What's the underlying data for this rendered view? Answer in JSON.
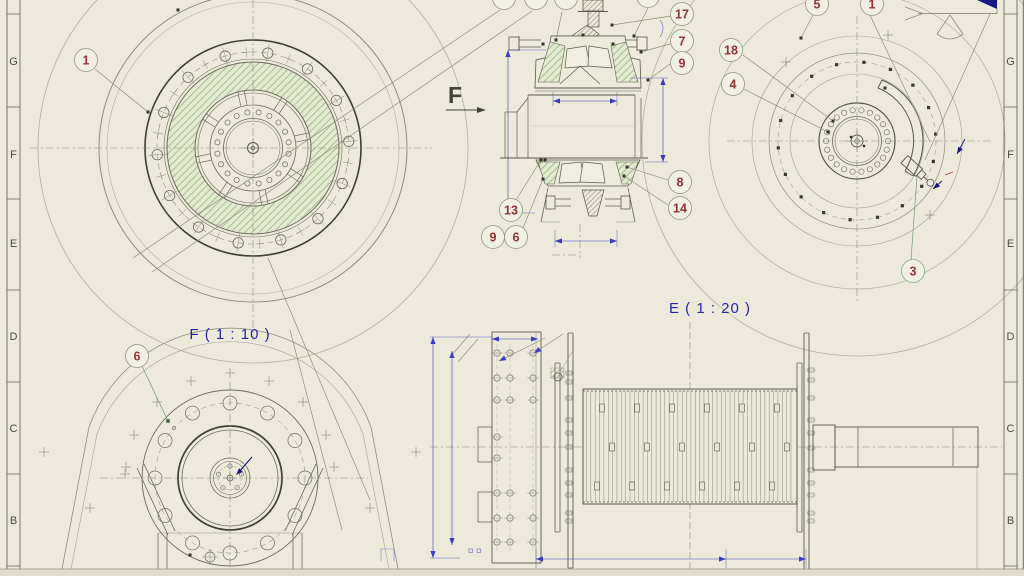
{
  "zones": [
    "G",
    "F",
    "E",
    "D",
    "C",
    "B"
  ],
  "labels": {
    "view_f": "F ( 1 : 10 )",
    "view_e": "E ( 1 : 20 )",
    "direction": "F"
  },
  "balloons": [
    {
      "id": "front-1",
      "label": "1"
    },
    {
      "id": "section-17",
      "label": "17"
    },
    {
      "id": "section-7",
      "label": "7"
    },
    {
      "id": "section-9-upper",
      "label": "9"
    },
    {
      "id": "section-8",
      "label": "8"
    },
    {
      "id": "section-14",
      "label": "14"
    },
    {
      "id": "section-13",
      "label": "13"
    },
    {
      "id": "section-9-lower",
      "label": "9"
    },
    {
      "id": "section-6",
      "label": "6"
    },
    {
      "id": "rear-5",
      "label": "5"
    },
    {
      "id": "rear-1",
      "label": "1"
    },
    {
      "id": "rear-18",
      "label": "18"
    },
    {
      "id": "rear-4",
      "label": "4"
    },
    {
      "id": "rear-3",
      "label": "3"
    },
    {
      "id": "pedestal-6",
      "label": "6"
    }
  ],
  "colors": {
    "background": "#edeadb",
    "line": "#5a584a",
    "bold_line": "#3f3e33",
    "faint": "#b2af9b",
    "centerline": "#8e8c78",
    "hatch_green": "#9dbb80",
    "hatch_tint": "#e4e9d2",
    "dimension_blue": "#3c3cc0",
    "label_blue": "#2525ae",
    "balloon_red": "#963038",
    "navy": "#16167e",
    "green_leader": "#6f9b6f"
  }
}
